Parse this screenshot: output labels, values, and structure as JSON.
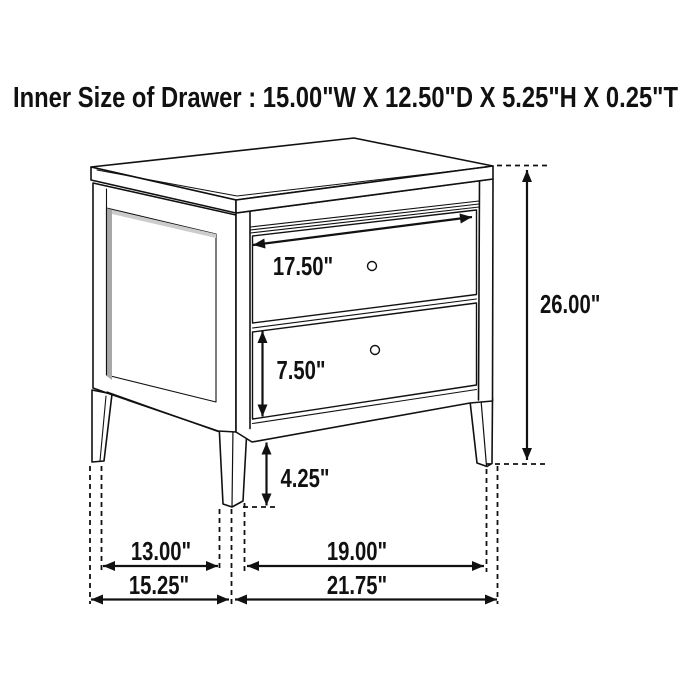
{
  "title": "Inner Size of Drawer : 15.00\"W X 12.50\"D X 5.25\"H X 0.25\"T",
  "labels": {
    "drawer_front_width": "17.50\"",
    "second_drawer_height": "7.50\"",
    "bottom_clearance": "4.25\"",
    "overall_height": "26.00\"",
    "leg_span_depth": "13.00\"",
    "leg_span_width": "19.00\"",
    "overall_depth": "15.25\"",
    "overall_width": "21.75\""
  },
  "colors": {
    "line": "#111111",
    "background": "#ffffff",
    "panel_shadow": "#a8a8a8"
  }
}
